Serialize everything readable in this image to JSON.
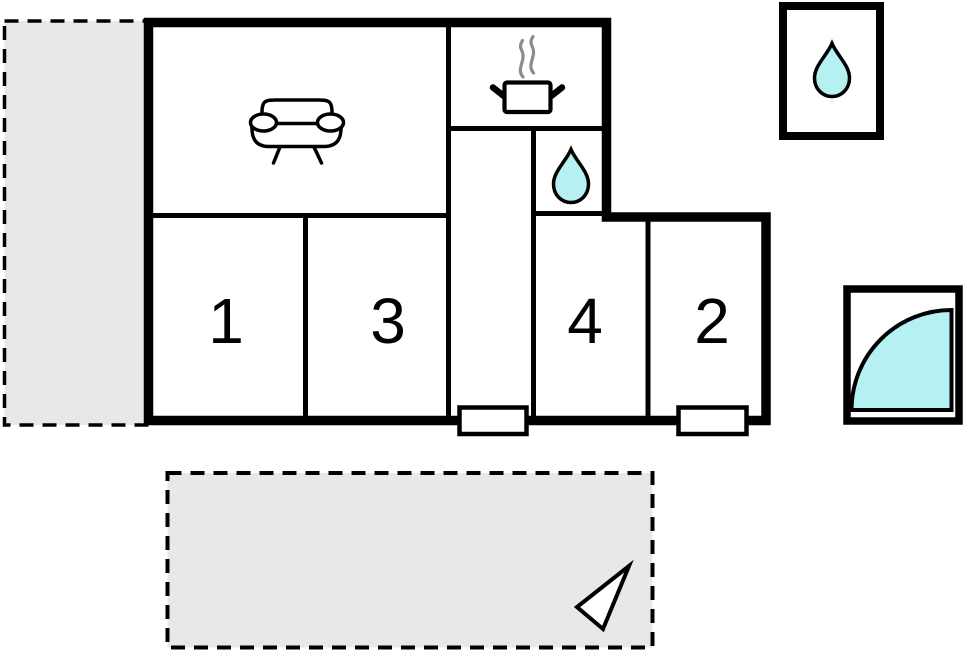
{
  "plan": {
    "type": "floor-plan",
    "rooms": [
      {
        "name": "bedroom-1",
        "label": "1"
      },
      {
        "name": "bedroom-3",
        "label": "3"
      },
      {
        "name": "bedroom-4",
        "label": "4"
      },
      {
        "name": "bedroom-2",
        "label": "2"
      }
    ],
    "unlabeled_areas": [
      {
        "name": "living-room",
        "icon": "sofa-icon"
      },
      {
        "name": "kitchen",
        "icon": "cooking-pot-icon"
      },
      {
        "name": "bathroom",
        "icon": "water-drop-icon"
      },
      {
        "name": "hallway",
        "icon": null
      },
      {
        "name": "outbuilding-utility",
        "icon": "water-drop-icon"
      },
      {
        "name": "outbuilding-shower",
        "icon": "quarter-circle-icon"
      },
      {
        "name": "terrace-left",
        "icon": null
      },
      {
        "name": "terrace-bottom",
        "icon": "north-arrow-icon"
      }
    ],
    "door_count": 2
  },
  "colors": {
    "wall": "#000000",
    "terrace_fill": "#e8e8e8",
    "water_fill": "#b5f1f3",
    "steam": "#8c8c8c",
    "floor_fill": "#ffffff"
  }
}
